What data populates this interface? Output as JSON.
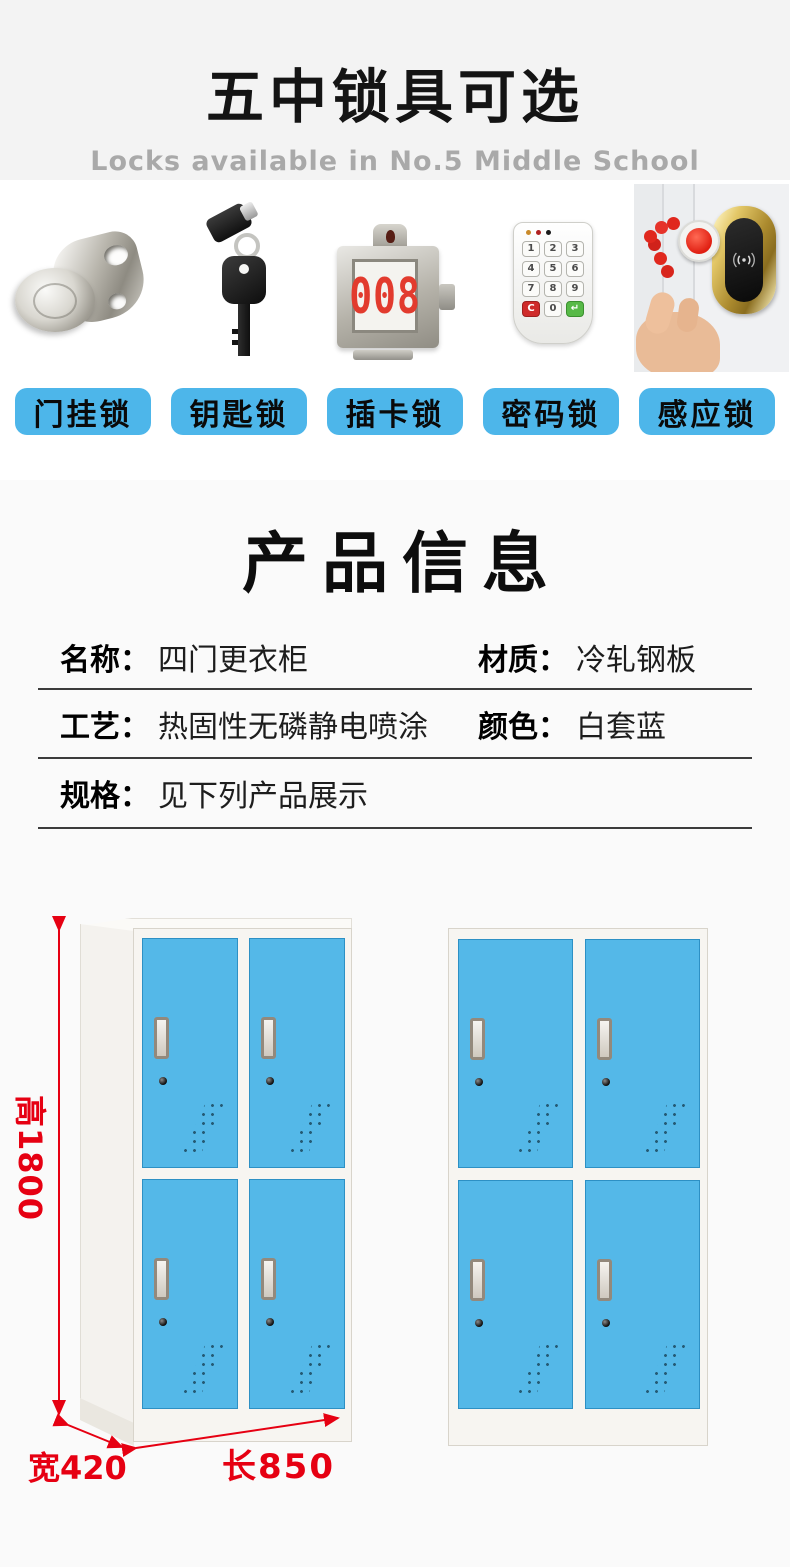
{
  "header": {
    "title": "五中锁具可选",
    "subtitle": "Locks available in No.5 Middle School"
  },
  "locks": {
    "items": [
      {
        "name": "cam-lock",
        "label": "门挂锁"
      },
      {
        "name": "key-lock",
        "label": "钥匙锁"
      },
      {
        "name": "card-lock",
        "label": "插卡锁",
        "number": "008"
      },
      {
        "name": "keypad-lock",
        "label": "密码锁",
        "keys": [
          "1",
          "2",
          "3",
          "4",
          "5",
          "6",
          "7",
          "8",
          "9",
          "C",
          "0",
          "↵"
        ]
      },
      {
        "name": "rfid-lock",
        "label": "感应锁"
      }
    ]
  },
  "info": {
    "title": "产品信息",
    "fields": {
      "name": {
        "label": "名称：",
        "value": "四门更衣柜"
      },
      "material": {
        "label": "材质：",
        "value": "冷轧钢板"
      },
      "process": {
        "label": "工艺：",
        "value": "热固性无磷静电喷涂"
      },
      "color": {
        "label": "颜色：",
        "value": "白套蓝"
      },
      "spec": {
        "label": "规格：",
        "value": "见下列产品展示"
      }
    }
  },
  "dims": {
    "height": "高1800",
    "width": "宽420",
    "length": "长850"
  },
  "colors": {
    "chip_blue": "#4db6ea",
    "door_blue": "#54b8e8",
    "dimension_red": "#e60012",
    "lock_number_red": "#e23b2e",
    "hero_bg": "#f3f3f3",
    "section_bg": "#fafafa"
  }
}
